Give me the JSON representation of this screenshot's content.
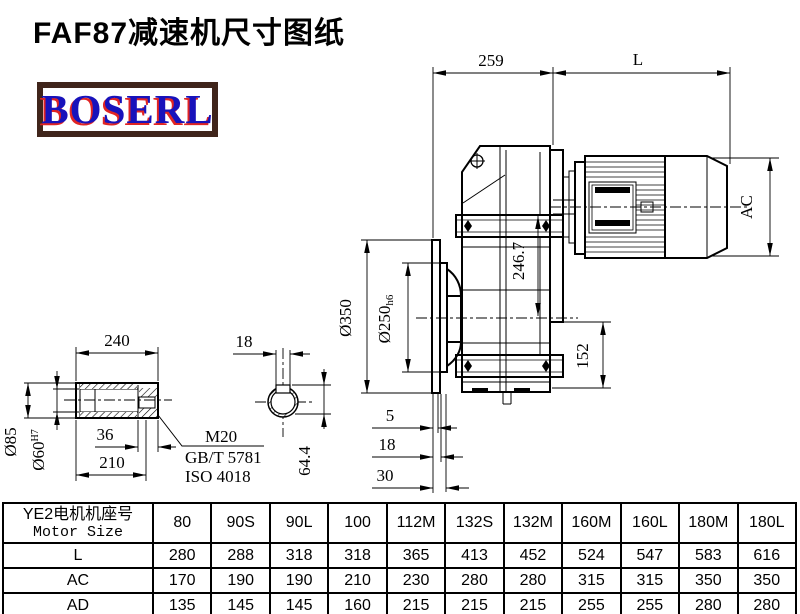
{
  "page": {
    "title": "FAF87减速机尺寸图纸"
  },
  "logo": {
    "text": "BOSERL",
    "border_color": "#40251b",
    "text_color": "#1812bb",
    "shadow_color": "#e02424"
  },
  "drawing": {
    "top_width": "259",
    "motor_length": "L",
    "motor_diameter": "AC",
    "flange_diameter": "Ø350",
    "pilot_diameter_base": "Ø250",
    "pilot_diameter_tol": "h6",
    "center_height": "246.7",
    "foot_height": "152",
    "step_5": "5",
    "step_18": "18",
    "step_30": "30",
    "shaft_length": "240",
    "keyway_width": "18",
    "shaft_dia": "Ø85",
    "bore_dia_base": "Ø60",
    "bore_dia_tol": "H7",
    "dim_36": "36",
    "dim_210": "210",
    "keyway_depth": "64.4",
    "bolt_thread": "M20",
    "bolt_standard": "GB/T 5781",
    "bolt_iso": "ISO 4018"
  },
  "table": {
    "header_cn": "YE2电机机座号",
    "header_en": "Motor Size",
    "columns": [
      "80",
      "90S",
      "90L",
      "100",
      "112M",
      "132S",
      "132M",
      "160M",
      "160L",
      "180M",
      "180L"
    ],
    "rows": [
      {
        "label": "L",
        "values": [
          280,
          288,
          318,
          318,
          365,
          413,
          452,
          524,
          547,
          583,
          616
        ]
      },
      {
        "label": "AC",
        "values": [
          170,
          190,
          190,
          210,
          230,
          280,
          280,
          315,
          315,
          350,
          350
        ]
      },
      {
        "label": "AD",
        "values": [
          135,
          145,
          145,
          160,
          215,
          215,
          215,
          255,
          255,
          280,
          280
        ]
      }
    ]
  }
}
